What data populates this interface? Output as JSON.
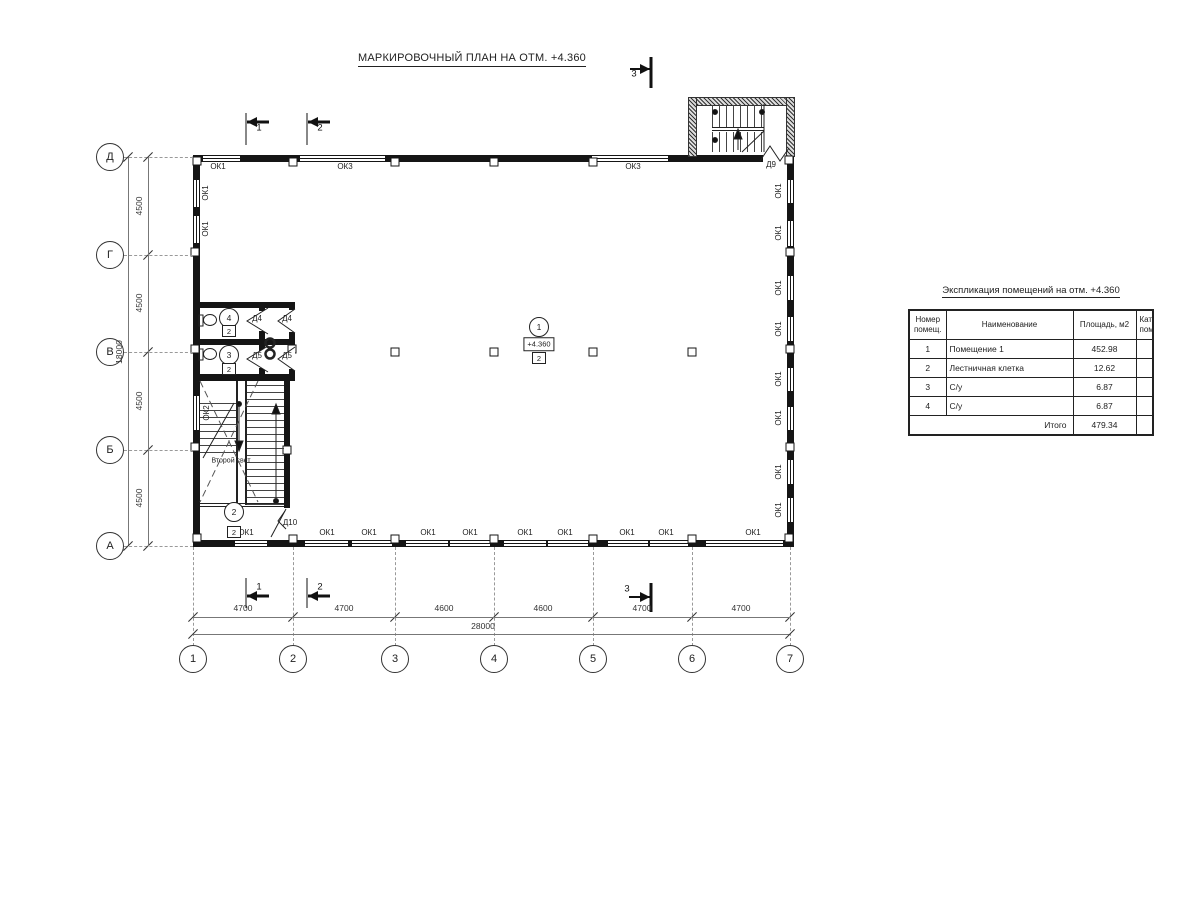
{
  "plan": {
    "title": "МАРКИРОВОЧНЫЙ ПЛАН НА ОТМ. +4.360",
    "second_light_label": "Второй свет",
    "ok_labels": [
      {
        "t": "ОК1",
        "x": 218,
        "y": 167
      },
      {
        "t": "ОК3",
        "x": 345,
        "y": 167
      },
      {
        "t": "ОК3",
        "x": 633,
        "y": 167
      },
      {
        "t": "ОК1",
        "x": 246,
        "y": 533
      },
      {
        "t": "ОК1",
        "x": 327,
        "y": 533
      },
      {
        "t": "ОК1",
        "x": 369,
        "y": 533
      },
      {
        "t": "ОК1",
        "x": 428,
        "y": 533
      },
      {
        "t": "ОК1",
        "x": 470,
        "y": 533
      },
      {
        "t": "ОК1",
        "x": 525,
        "y": 533
      },
      {
        "t": "ОК1",
        "x": 565,
        "y": 533
      },
      {
        "t": "ОК1",
        "x": 627,
        "y": 533
      },
      {
        "t": "ОК1",
        "x": 666,
        "y": 533
      },
      {
        "t": "ОК1",
        "x": 753,
        "y": 533
      }
    ],
    "ok_labels_rot": [
      {
        "t": "ОК1",
        "x": 206,
        "y": 193
      },
      {
        "t": "ОК1",
        "x": 206,
        "y": 229
      },
      {
        "t": "ОК2",
        "x": 207,
        "y": 413
      },
      {
        "t": "ОК1",
        "x": 779,
        "y": 191
      },
      {
        "t": "ОК1",
        "x": 779,
        "y": 233
      },
      {
        "t": "ОК1",
        "x": 779,
        "y": 288
      },
      {
        "t": "ОК1",
        "x": 779,
        "y": 329
      },
      {
        "t": "ОК1",
        "x": 779,
        "y": 379
      },
      {
        "t": "ОК1",
        "x": 779,
        "y": 418
      },
      {
        "t": "ОК1",
        "x": 779,
        "y": 472
      },
      {
        "t": "ОК1",
        "x": 779,
        "y": 510
      }
    ],
    "door_labels": [
      {
        "t": "Д4",
        "x": 257,
        "y": 319
      },
      {
        "t": "Д4",
        "x": 287,
        "y": 319
      },
      {
        "t": "Д5",
        "x": 257,
        "y": 356
      },
      {
        "t": "Д5",
        "x": 287,
        "y": 356
      },
      {
        "t": "Д9",
        "x": 771,
        "y": 165
      },
      {
        "t": "Д10",
        "x": 290,
        "y": 523
      }
    ],
    "rooms": [
      {
        "num": "1",
        "cx": 539,
        "cy": 327,
        "cat": "2",
        "elev": "+4.360",
        "elev_dy": 17,
        "cat_dy": 31
      },
      {
        "num": "2",
        "cx": 234,
        "cy": 512,
        "cat": "2",
        "cat_dy": 20
      },
      {
        "num": "3",
        "cx": 229,
        "cy": 355,
        "cat": "2",
        "cat_dy": 14
      },
      {
        "num": "4",
        "cx": 229,
        "cy": 318,
        "cat": "2",
        "cat_dy": 13
      }
    ],
    "axes_bottom": [
      {
        "label": "1",
        "x": 193
      },
      {
        "label": "2",
        "x": 293
      },
      {
        "label": "3",
        "x": 395
      },
      {
        "label": "4",
        "x": 494
      },
      {
        "label": "5",
        "x": 593
      },
      {
        "label": "6",
        "x": 692
      },
      {
        "label": "7",
        "x": 790
      }
    ],
    "axes_left": [
      {
        "label": "Д",
        "y": 157
      },
      {
        "label": "Г",
        "y": 255
      },
      {
        "label": "В",
        "y": 352
      },
      {
        "label": "Б",
        "y": 450
      },
      {
        "label": "А",
        "y": 546
      }
    ],
    "dim_bottom": [
      {
        "t": "4700",
        "x": 243
      },
      {
        "t": "4700",
        "x": 344
      },
      {
        "t": "4600",
        "x": 444
      },
      {
        "t": "4600",
        "x": 543
      },
      {
        "t": "4700",
        "x": 642
      },
      {
        "t": "4700",
        "x": 741
      }
    ],
    "dim_bottom_total": "28000",
    "dim_left": [
      {
        "t": "4500",
        "y": 206
      },
      {
        "t": "4500",
        "y": 303
      },
      {
        "t": "4500",
        "y": 401
      },
      {
        "t": "4500",
        "y": 498
      }
    ],
    "dim_left_total": "18000",
    "section_markers": [
      {
        "t": "1",
        "x": 259,
        "y": 128
      },
      {
        "t": "2",
        "x": 320,
        "y": 128
      },
      {
        "t": "3",
        "x": 634,
        "y": 74
      },
      {
        "t": "1",
        "x": 259,
        "y": 587
      },
      {
        "t": "2",
        "x": 320,
        "y": 587
      },
      {
        "t": "3",
        "x": 627,
        "y": 589
      }
    ]
  },
  "schedule": {
    "title": "Экспликация помещений на отм. +4.360",
    "headers": [
      "Номер\nпомещ.",
      "Наименование",
      "Площадь,   м2",
      "Кат.\nпом."
    ],
    "rows": [
      [
        "1",
        "Помещение 1",
        "452.98",
        ""
      ],
      [
        "2",
        "Лестничная клетка",
        "12.62",
        ""
      ],
      [
        "3",
        "С/у",
        "6.87",
        ""
      ],
      [
        "4",
        "С/у",
        "6.87",
        ""
      ]
    ],
    "total_label": "Итого",
    "total_value": "479.34"
  }
}
